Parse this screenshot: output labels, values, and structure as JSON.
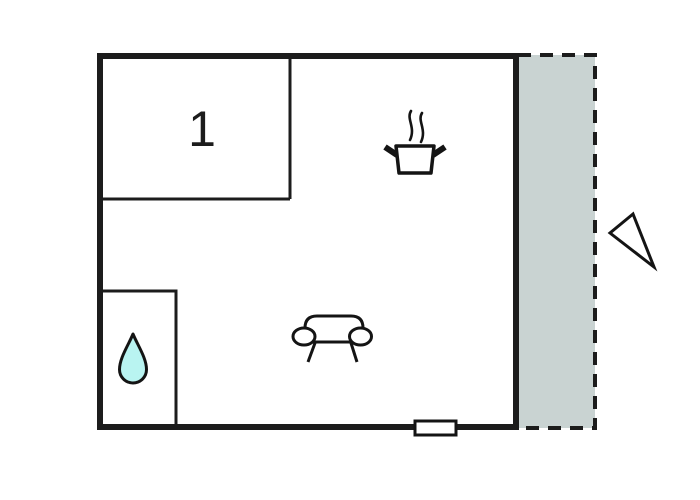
{
  "title": "apartment-floor-plan",
  "colors": {
    "background": "#ffffff",
    "wall": "#1c1c1c",
    "inner_wall": "#1c1c1c",
    "terrace_fill": "#c9d3d2",
    "drop_fill": "#b9f4f1",
    "icon_stroke": "#141414",
    "marker_fill": "#ffffff"
  },
  "rooms": {
    "room1": {
      "label": "1"
    },
    "bathroom": {
      "icon": "water-drop-icon"
    },
    "living_area": {
      "icons": [
        "cooking-pot-icon",
        "sofa-icon"
      ]
    },
    "terrace": {
      "border_style": "dashed",
      "shaded": true
    }
  },
  "markers": {
    "door": "door-window-marker",
    "compass": "direction-triangle"
  }
}
